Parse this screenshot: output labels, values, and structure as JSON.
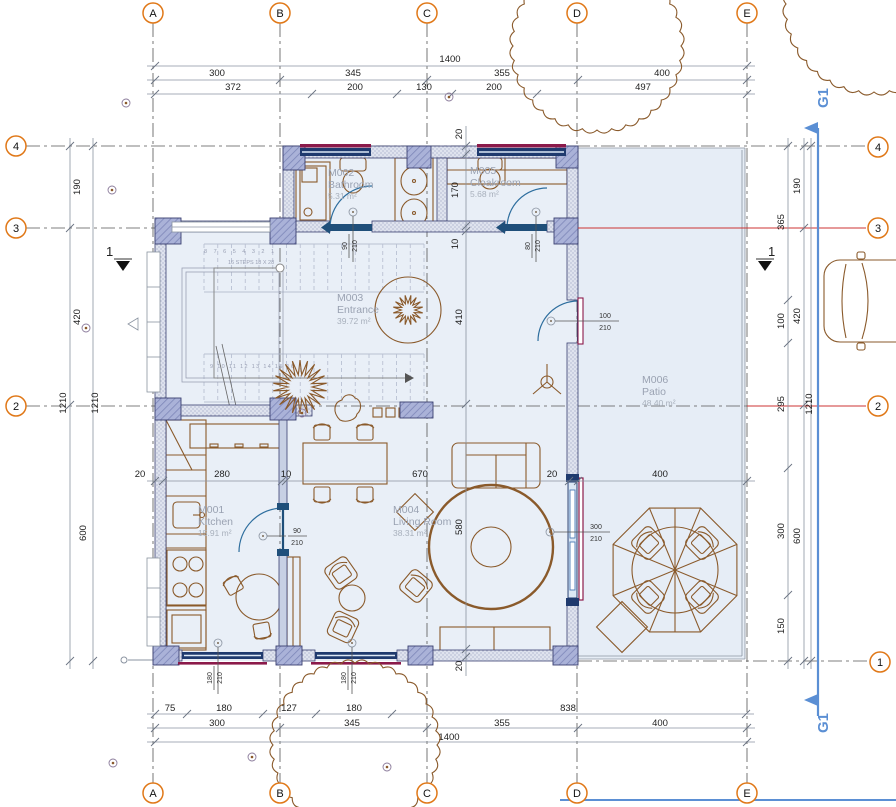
{
  "grid": {
    "top": [
      "A",
      "B",
      "C",
      "D",
      "E"
    ],
    "bottom": [
      "A",
      "B",
      "C",
      "D",
      "E"
    ],
    "left": [
      "4",
      "3",
      "2"
    ],
    "right": [
      "4",
      "3",
      "2",
      "1"
    ]
  },
  "rooms": {
    "kitchen": {
      "id": "M001",
      "name": "Kitchen",
      "area": "15.91 m²"
    },
    "bathroom": {
      "id": "M002",
      "name": "Bathroom",
      "area": "5.31 m²"
    },
    "entrance": {
      "id": "M003",
      "name": "Entrance",
      "area": "39.72 m²"
    },
    "living": {
      "id": "M004",
      "name": "Living Room",
      "area": "38.31 m²"
    },
    "cloakroom": {
      "id": "M005",
      "name": "Cloakroom",
      "area": "5.68 m²"
    },
    "patio": {
      "id": "M006",
      "name": "Patio",
      "area": "48.40 m²"
    }
  },
  "dims": {
    "top_total": "1400",
    "top_major": [
      "300",
      "345",
      "355",
      "400"
    ],
    "top_minor": [
      "372",
      "200",
      "130",
      "200",
      "497"
    ],
    "bottom_minor": [
      "75",
      "180",
      "127",
      "180",
      "838"
    ],
    "bottom_major": [
      "300",
      "345",
      "355",
      "400"
    ],
    "bottom_total": "1400",
    "left_segments": [
      "190",
      "420",
      "600"
    ],
    "left_total_a": "1210",
    "left_total_b": "1210",
    "right_inner": [
      "365",
      "100",
      "295",
      "300",
      "150"
    ],
    "right_outer": [
      "190",
      "420",
      "600"
    ],
    "right_total": "1210",
    "inner_h": [
      "20",
      "280",
      "10",
      "670",
      "20",
      "400"
    ],
    "inner_v": [
      "20",
      "170",
      "10",
      "410",
      "580",
      "20"
    ]
  },
  "openings": {
    "bathroom_door": {
      "w": "90",
      "h": "210"
    },
    "cloakroom_door": {
      "w": "80",
      "h": "210"
    },
    "kitchen_door": {
      "w": "90",
      "h": "210"
    },
    "entrance_door": {
      "w": "100",
      "h": "210"
    },
    "patio_door": {
      "w": "300",
      "h": "210"
    },
    "window_sw1": {
      "w": "180",
      "h": "210"
    },
    "window_sw2": {
      "w": "180",
      "h": "210"
    }
  },
  "stairs": {
    "note": "16 STEPS 18 X 28",
    "upper_numbers": "8  7  6  5  4  3  2  1",
    "lower_numbers": "9 10 11 12 13 14 15 16"
  },
  "sections": {
    "left_mark": "1",
    "right_mark": "1",
    "g_top": "G1",
    "g_bottom": "G1"
  },
  "colors": {
    "accent_orange": "#e07818",
    "section_blue": "#5b8fd4",
    "grid_red": "#cc3333",
    "furniture_brown": "#8a5a2b",
    "wall_navy": "#2f3660",
    "door_blue": "#2e6e9e",
    "glass_maroon": "#8b1a4a",
    "room_fill": "#e9eff7",
    "dim_gray": "#8a93a0"
  }
}
